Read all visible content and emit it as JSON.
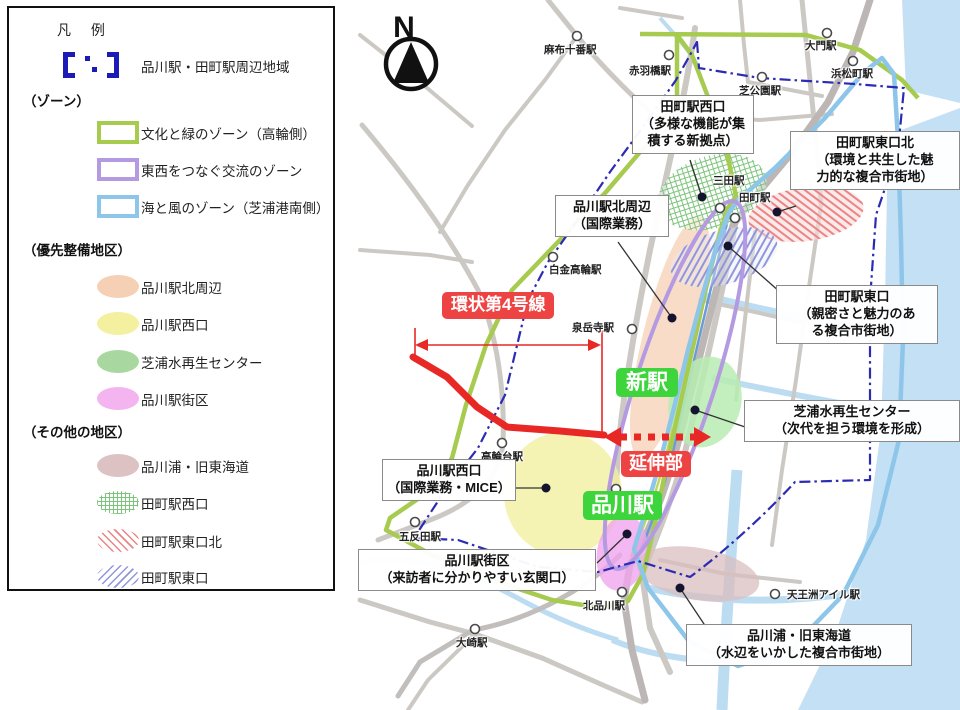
{
  "legend": {
    "title": "凡 例",
    "boundary_item": "品川駅・田町駅周辺地域",
    "sections": {
      "zones": "（ゾーン）",
      "priority": "（優先整備地区）",
      "other": "（その他の地区）"
    },
    "zones": [
      {
        "label": "文化と緑のゾーン（高輪側）",
        "color": "#a6cb4e"
      },
      {
        "label": "東西をつなぐ交流のゾーン",
        "color": "#b49ae1"
      },
      {
        "label": "海と風のゾーン（芝浦港南側）",
        "color": "#8ec6ea"
      }
    ],
    "priority": [
      {
        "label": "品川駅北周辺",
        "color": "#f6d0b4"
      },
      {
        "label": "品川駅西口",
        "color": "#f3f0a0"
      },
      {
        "label": "芝浦水再生センター",
        "color": "#a8d8a0"
      },
      {
        "label": "品川駅街区",
        "color": "#f3b4ef"
      }
    ],
    "other": [
      {
        "label": "品川浦・旧東海道",
        "color": "#dcc2c2"
      },
      {
        "label": "田町駅西口",
        "color": "#7cc47c"
      },
      {
        "label": "田町駅東口北",
        "color": "#ec8484"
      },
      {
        "label": "田町駅東口",
        "color": "#9096dc"
      }
    ]
  },
  "map": {
    "north": "N",
    "stations": [
      "麻布十番駅",
      "赤羽橋駅",
      "大門駅",
      "浜松町駅",
      "芝公園駅",
      "三田駅",
      "田町駅",
      "白金高輪駅",
      "泉岳寺駅",
      "高輪台駅",
      "五反田駅",
      "大崎駅",
      "北品川駅",
      "天王洲アイル駅"
    ],
    "callouts": [
      {
        "text": "田町駅西口\n（多様な機能が集\n積する新拠点）"
      },
      {
        "text": "品川駅北周辺\n（国際業務）"
      },
      {
        "text": "田町駅東口北\n（環境と共生した魅\n力的な複合市街地）"
      },
      {
        "text": "田町駅東口\n（親密さと魅力のあ\nる複合市街地）"
      },
      {
        "text": "芝浦水再生センター\n（次代を担う環境を形成）"
      },
      {
        "text": "品川駅西口\n（国際業務・MICE）"
      },
      {
        "text": "品川駅街区\n（来訪者に分かりやすい玄関口）"
      },
      {
        "text": "品川浦・旧東海道\n（水辺をいかした複合市街地）"
      }
    ],
    "tags": {
      "ring_road": "環状第4号線",
      "extension": "延伸部",
      "new_station": "新駅",
      "shinagawa": "品川駅"
    }
  }
}
